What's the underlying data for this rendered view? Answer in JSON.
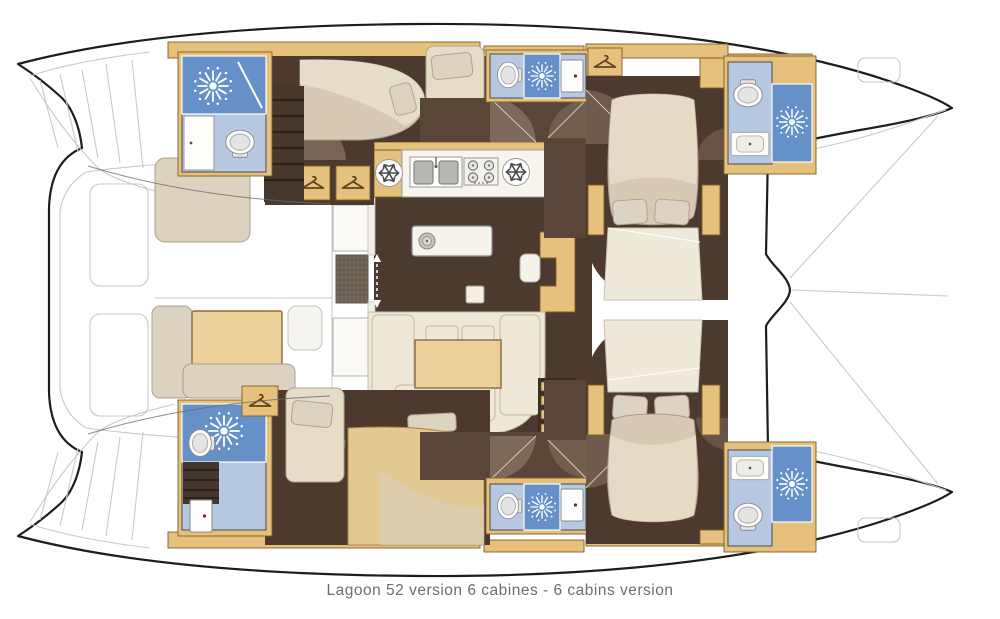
{
  "caption": "Lagoon 52 version 6 cabines - 6 cabins version",
  "palette": {
    "paper": "#ffffff",
    "outline": "#1d1d1b",
    "deck_line": "#c9c9c9",
    "wood": "#e5c17d",
    "wood_edge": "#7d5d27",
    "floor_dark": "#4d3a2f",
    "floor_mid": "#8a7666",
    "corridor": "#5a4638",
    "bath_light": "#b7c8e2",
    "bath_dark": "#6691c8",
    "bed_cream": "#e6dcc8",
    "bed_stroke": "#b0a58f",
    "bed_tan": "#e2c891",
    "sofa": "#efe8d7",
    "table": "#ecd09a",
    "fixture_white": "#fdfdfa",
    "fixture_stroke": "#9a9a9a",
    "caption_color": "#6d6d6d"
  },
  "legend": {
    "shower": "shower-rose-icon",
    "toilet": "toilet-icon",
    "wardrobe": "hanger-icon",
    "fridge": "snowflake-icon",
    "stove": "stove-burners-icon",
    "galley_sink": "double-sink-icon",
    "island_sink": "round-sink-icon",
    "vanity": "vanity-sink-icon",
    "cabin_door": "door-panel-icon",
    "entry": "sliding-door-arrows-icon"
  }
}
